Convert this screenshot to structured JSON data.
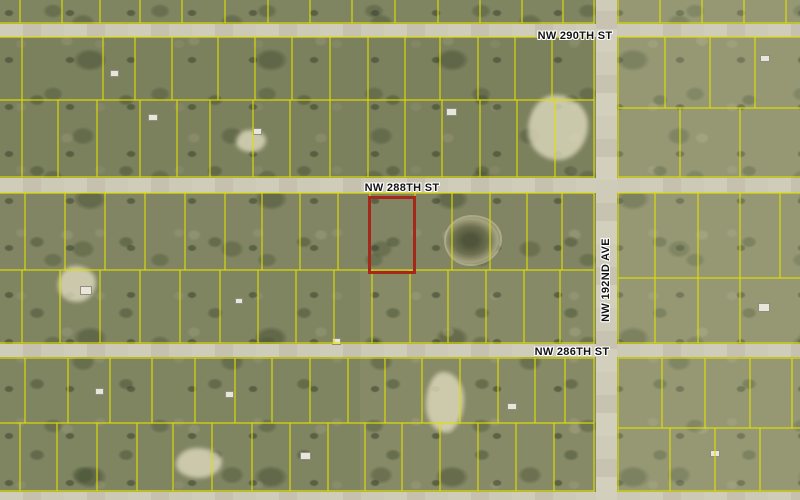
{
  "map": {
    "type": "aerial-parcel-map",
    "colors": {
      "parcel_line": "#e0e000",
      "highlight_outline": "#a5281a",
      "road": "#cdc9b7",
      "label_text": "#121212",
      "label_halo": "#ffffff"
    },
    "labels": [
      {
        "text": "NW 290TH ST",
        "x": 575,
        "y": 36,
        "orientation": "horizontal"
      },
      {
        "text": "NW 288TH ST",
        "x": 402,
        "y": 188,
        "orientation": "horizontal"
      },
      {
        "text": "NW 286TH ST",
        "x": 572,
        "y": 352,
        "orientation": "horizontal"
      },
      {
        "text": "NW 192ND AVE",
        "x": 606,
        "y": 280,
        "orientation": "vertical"
      }
    ],
    "roads": [
      {
        "id": "nw-290th-st",
        "type": "horizontal",
        "x": 0,
        "y": 24,
        "w": 800,
        "h": 13
      },
      {
        "id": "nw-288th-st",
        "type": "horizontal",
        "x": 0,
        "y": 178,
        "w": 800,
        "h": 15
      },
      {
        "id": "nw-286th-st",
        "type": "horizontal",
        "x": 0,
        "y": 344,
        "w": 800,
        "h": 13
      },
      {
        "id": "south-road",
        "type": "horizontal",
        "x": 0,
        "y": 492,
        "w": 800,
        "h": 8
      },
      {
        "id": "nw-192nd-ave",
        "type": "vertical",
        "x": 596,
        "y": 0,
        "w": 21,
        "h": 500
      }
    ],
    "highlighted_parcel": {
      "x": 368,
      "y": 196,
      "w": 48,
      "h": 78
    },
    "pond": {
      "x": 446,
      "y": 217,
      "w": 54,
      "h": 47
    },
    "terrain": {
      "tones": [
        {
          "x": 618,
          "y": 0,
          "w": 182,
          "h": 500,
          "color": "#cfcbaa",
          "opacity": 0.22
        },
        {
          "x": 0,
          "y": 38,
          "w": 594,
          "h": 140,
          "color": "#46543a",
          "opacity": 0.18
        },
        {
          "x": 0,
          "y": 194,
          "w": 594,
          "h": 76,
          "color": "#55624a",
          "opacity": 0.1
        },
        {
          "x": 0,
          "y": 270,
          "w": 360,
          "h": 220,
          "color": "#4e5c40",
          "opacity": 0.12
        },
        {
          "x": 0,
          "y": 0,
          "w": 594,
          "h": 23,
          "color": "#4e5c40",
          "opacity": 0.12
        }
      ],
      "sand_patches": [
        [
          528,
          95,
          60,
          65
        ],
        [
          58,
          266,
          38,
          36
        ],
        [
          426,
          372,
          38,
          60
        ],
        [
          176,
          448,
          46,
          30
        ],
        [
          236,
          130,
          30,
          22
        ]
      ]
    },
    "structures": [
      [
        110,
        70,
        9,
        7
      ],
      [
        148,
        114,
        10,
        7
      ],
      [
        253,
        128,
        9,
        7
      ],
      [
        446,
        108,
        11,
        8
      ],
      [
        80,
        286,
        12,
        9
      ],
      [
        235,
        298,
        8,
        6
      ],
      [
        332,
        338,
        9,
        7
      ],
      [
        507,
        403,
        10,
        7
      ],
      [
        758,
        303,
        12,
        9
      ],
      [
        710,
        450,
        10,
        7
      ],
      [
        300,
        452,
        11,
        8
      ],
      [
        95,
        388,
        9,
        7
      ],
      [
        225,
        391,
        9,
        7
      ],
      [
        760,
        55,
        10,
        7
      ]
    ],
    "grid": {
      "h_segments": [
        [
          0,
          594,
          23
        ],
        [
          618,
          800,
          23
        ],
        [
          0,
          594,
          37
        ],
        [
          618,
          800,
          37
        ],
        [
          0,
          594,
          100
        ],
        [
          618,
          800,
          108
        ],
        [
          0,
          594,
          177
        ],
        [
          618,
          800,
          177
        ],
        [
          0,
          594,
          193
        ],
        [
          618,
          800,
          193
        ],
        [
          0,
          594,
          270
        ],
        [
          618,
          800,
          278
        ],
        [
          0,
          594,
          343
        ],
        [
          618,
          800,
          343
        ],
        [
          0,
          594,
          358
        ],
        [
          618,
          800,
          358
        ],
        [
          0,
          594,
          423
        ],
        [
          618,
          800,
          428
        ],
        [
          0,
          594,
          491
        ],
        [
          618,
          800,
          491
        ]
      ],
      "v_segments": [
        [
          0,
          24,
          594
        ],
        [
          37,
          178,
          594
        ],
        [
          193,
          344,
          594
        ],
        [
          357,
          492,
          594
        ],
        [
          0,
          24,
          618
        ],
        [
          37,
          178,
          618
        ],
        [
          193,
          344,
          618
        ],
        [
          357,
          492,
          618
        ],
        [
          0,
          23,
          20
        ],
        [
          0,
          23,
          62
        ],
        [
          0,
          23,
          100
        ],
        [
          0,
          23,
          140
        ],
        [
          0,
          23,
          182
        ],
        [
          0,
          23,
          225
        ],
        [
          0,
          23,
          268
        ],
        [
          0,
          23,
          310
        ],
        [
          0,
          23,
          352
        ],
        [
          0,
          23,
          395
        ],
        [
          0,
          23,
          438
        ],
        [
          0,
          23,
          480
        ],
        [
          0,
          23,
          522
        ],
        [
          0,
          23,
          563
        ],
        [
          0,
          23,
          660
        ],
        [
          0,
          23,
          702
        ],
        [
          0,
          23,
          744
        ],
        [
          0,
          23,
          786
        ],
        [
          37,
          100,
          22
        ],
        [
          37,
          100,
          103
        ],
        [
          37,
          100,
          135
        ],
        [
          37,
          100,
          172
        ],
        [
          37,
          100,
          218
        ],
        [
          37,
          100,
          255
        ],
        [
          37,
          100,
          292
        ],
        [
          37,
          100,
          330
        ],
        [
          37,
          100,
          368
        ],
        [
          37,
          100,
          405
        ],
        [
          37,
          100,
          440
        ],
        [
          37,
          100,
          478
        ],
        [
          37,
          100,
          515
        ],
        [
          37,
          100,
          552
        ],
        [
          37,
          108,
          665
        ],
        [
          37,
          108,
          710
        ],
        [
          37,
          108,
          755
        ],
        [
          100,
          177,
          22
        ],
        [
          100,
          177,
          58
        ],
        [
          100,
          177,
          97
        ],
        [
          100,
          177,
          140
        ],
        [
          100,
          177,
          177
        ],
        [
          100,
          177,
          210
        ],
        [
          100,
          177,
          253
        ],
        [
          100,
          177,
          290
        ],
        [
          100,
          177,
          330
        ],
        [
          100,
          177,
          368
        ],
        [
          100,
          177,
          405
        ],
        [
          100,
          177,
          442
        ],
        [
          100,
          177,
          480
        ],
        [
          100,
          177,
          517
        ],
        [
          100,
          177,
          555
        ],
        [
          108,
          177,
          680
        ],
        [
          108,
          177,
          740
        ],
        [
          193,
          270,
          25
        ],
        [
          193,
          270,
          65
        ],
        [
          193,
          270,
          105
        ],
        [
          193,
          270,
          145
        ],
        [
          193,
          270,
          185
        ],
        [
          193,
          270,
          225
        ],
        [
          193,
          270,
          262
        ],
        [
          193,
          270,
          300
        ],
        [
          193,
          270,
          338
        ],
        [
          193,
          270,
          370
        ],
        [
          193,
          270,
          415
        ],
        [
          193,
          270,
          452
        ],
        [
          193,
          270,
          490
        ],
        [
          193,
          270,
          527
        ],
        [
          193,
          270,
          562
        ],
        [
          193,
          278,
          655
        ],
        [
          193,
          278,
          698
        ],
        [
          193,
          278,
          740
        ],
        [
          193,
          278,
          780
        ],
        [
          270,
          343,
          22
        ],
        [
          270,
          343,
          60
        ],
        [
          270,
          343,
          100
        ],
        [
          270,
          343,
          140
        ],
        [
          270,
          343,
          180
        ],
        [
          270,
          343,
          220
        ],
        [
          270,
          343,
          258
        ],
        [
          270,
          343,
          296
        ],
        [
          270,
          343,
          334
        ],
        [
          270,
          343,
          372
        ],
        [
          270,
          343,
          410
        ],
        [
          270,
          343,
          448
        ],
        [
          270,
          343,
          486
        ],
        [
          270,
          343,
          524
        ],
        [
          270,
          343,
          560
        ],
        [
          278,
          343,
          655
        ],
        [
          278,
          343,
          698
        ],
        [
          278,
          343,
          740
        ],
        [
          358,
          423,
          25
        ],
        [
          358,
          423,
          68
        ],
        [
          358,
          423,
          110
        ],
        [
          358,
          423,
          152
        ],
        [
          358,
          423,
          195
        ],
        [
          358,
          423,
          235
        ],
        [
          358,
          423,
          272
        ],
        [
          358,
          423,
          310
        ],
        [
          358,
          423,
          348
        ],
        [
          358,
          423,
          385
        ],
        [
          358,
          423,
          422
        ],
        [
          358,
          423,
          460
        ],
        [
          358,
          423,
          498
        ],
        [
          358,
          423,
          535
        ],
        [
          358,
          423,
          565
        ],
        [
          358,
          428,
          662
        ],
        [
          358,
          428,
          705
        ],
        [
          358,
          428,
          750
        ],
        [
          358,
          428,
          792
        ],
        [
          423,
          491,
          20
        ],
        [
          423,
          491,
          57
        ],
        [
          423,
          491,
          97
        ],
        [
          423,
          491,
          137
        ],
        [
          423,
          491,
          173
        ],
        [
          423,
          491,
          212
        ],
        [
          423,
          491,
          252
        ],
        [
          423,
          491,
          290
        ],
        [
          423,
          491,
          328
        ],
        [
          423,
          491,
          365
        ],
        [
          423,
          491,
          402
        ],
        [
          423,
          491,
          440
        ],
        [
          423,
          491,
          478
        ],
        [
          423,
          491,
          516
        ],
        [
          423,
          491,
          554
        ],
        [
          428,
          491,
          670
        ],
        [
          428,
          491,
          715
        ],
        [
          428,
          491,
          760
        ]
      ]
    }
  }
}
